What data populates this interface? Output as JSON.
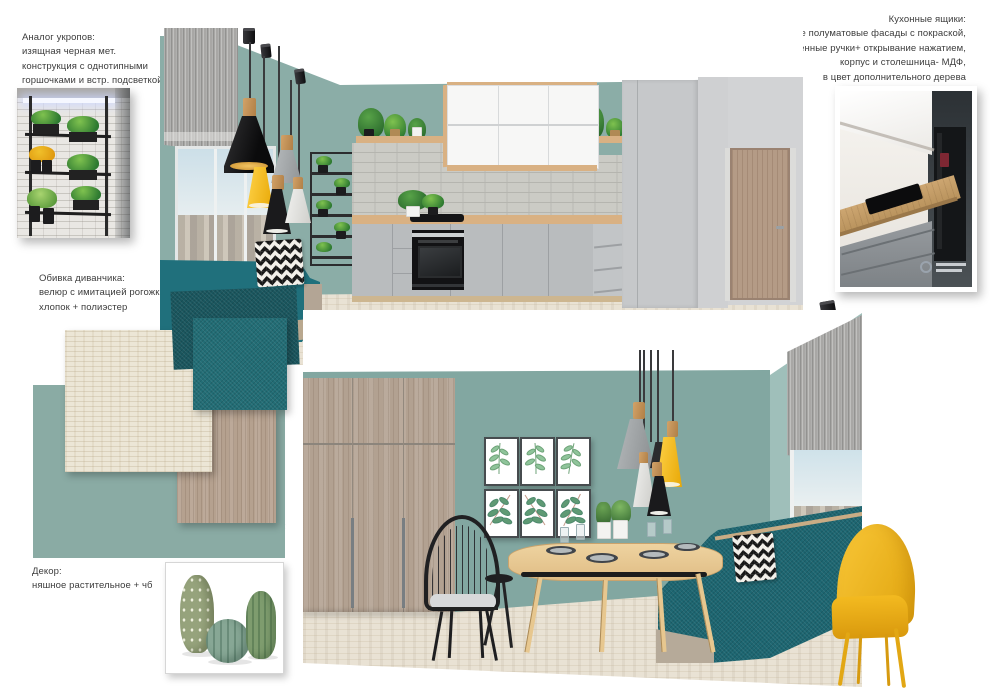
{
  "annotations": {
    "planter_analog": {
      "lines": [
        "Аналог укропов:",
        "изящная черная мет.",
        "конструкция с однотипными",
        "горшочками и встр. подсветкой"
      ]
    },
    "kitchen_drawers": {
      "lines": [
        "Кухонные ящики:",
        "гладкие полуматовые фасады с покраской,",
        "встроенные ручки+ открывание нажатием,",
        "корпус  и столешница- МДФ,",
        "в цвет дополнительного дерева"
      ]
    },
    "sofa_upholstery": {
      "lines": [
        "Обивка диванчика:",
        "велюр с имитацией рогожки/",
        "хлопок + полиэстер"
      ]
    },
    "cork_flooring": {
      "lines": [
        "Пробка: светлая",
        "здесь: Corkstyle, Linea white",
        "2300-3000 руб/м²"
      ]
    },
    "large_furniture": {
      "lines": [
        "Габаритная мебель, двери:",
        "шпон дуба, осветленный"
      ]
    },
    "decor": {
      "lines": [
        "Декор:",
        "няшное растительное + чб"
      ]
    }
  },
  "palette": {
    "ink": "#3c3c3c",
    "wall-teal": "#8bada7",
    "wall-teal-2": "#82a7a1",
    "wall-teal-light": "#9fbfba",
    "teal-panel": "#8aaba4",
    "swatch-teal": "#226d75",
    "swatch-teal-dark": "#1a565e",
    "banquette-teal": "#20707c",
    "banquette-teal-2": "#1d6671",
    "accent-yellow": "#f3b713",
    "counter-wood": "#d9b183",
    "cabinet-gray": "#b9bcbe",
    "wardrobe-gray": "#c6c8ca",
    "backsplash-gray": "#cbcbc5",
    "door-wood": "#b49b86",
    "wardrobe-wood": "#b2a191",
    "wood-swatch": "#b5a18f",
    "cork": "#ece6d6",
    "floor-cork": "#e9e2d4",
    "lamp-black": "#1d1d1f"
  }
}
